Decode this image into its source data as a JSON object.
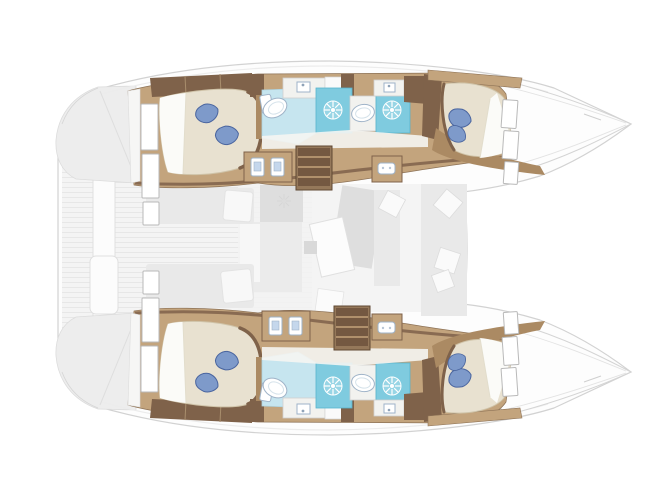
{
  "meta": {
    "name": "catamaran-yacht-floor-plan",
    "view": "top-down interior layout, bows to the right, no text labels in image"
  },
  "palette": {
    "hull-fill": "#fdfdfd",
    "hull-outline": "#d2d2d2",
    "deck-shade": "#ededed",
    "plank-base": "#f4f4f4",
    "plank-line": "#e6e6e6",
    "ghost": "#e9e9e9",
    "ghost-dark": "#dedede",
    "ghost-line": "#d8d8d8",
    "ghost-floor": "#f2f2f2",
    "wood": "#c3a47d",
    "wood-mid": "#ab8a63",
    "wood-dark": "#7f624a",
    "step-dark": "#745841",
    "step-light": "#caa87e",
    "mattress": "#e8e1d0",
    "mattress-edge": "#cfc3a8",
    "sheet": "#fbfbf8",
    "pillow": "#7e9aca",
    "pillow-dark": "#4a659f",
    "shower": "#7fcbdf",
    "shower-dark": "#58b4cd",
    "bath-floor": "#c6e5ef",
    "bath-edge": "#aed2de",
    "fix-stroke": "#9fb3c8",
    "fixture-blue": "#c5d7ec"
  },
  "layout": {
    "hulls": [
      {
        "id": "port-hull",
        "rooms": [
          {
            "name": "port-aft-cabin",
            "features": [
              "double-berth",
              "two-blue-pillows",
              "three-hull-windows",
              "wardrobe"
            ]
          },
          {
            "name": "port-aft-head",
            "features": [
              "wc",
              "sink-counter",
              "shower-with-star-drain",
              "blue-tile-floor"
            ]
          },
          {
            "name": "port-forward-head",
            "features": [
              "oval-sink",
              "shower-with-star-drain",
              "sink-counter"
            ]
          },
          {
            "name": "port-forward-cabin",
            "features": [
              "double-berth",
              "blue-pillow",
              "hull-windows"
            ]
          }
        ]
      },
      {
        "id": "starboard-hull",
        "rooms": [
          {
            "name": "starboard-aft-cabin",
            "features": [
              "double-berth",
              "two-blue-pillows",
              "three-hull-windows",
              "wardrobe"
            ]
          },
          {
            "name": "starboard-aft-head",
            "features": [
              "wc",
              "sink-counter",
              "shower-with-star-drain",
              "blue-tile-floor"
            ]
          },
          {
            "name": "starboard-forward-head",
            "features": [
              "oval-sink",
              "shower-with-star-drain",
              "sink-counter"
            ]
          },
          {
            "name": "starboard-forward-cabin",
            "features": [
              "double-berth",
              "blue-pillow",
              "hull-windows"
            ]
          }
        ]
      }
    ],
    "center": {
      "cockpit": [
        "teak-plank-deck",
        "cockpit-beam-with-fittings"
      ],
      "salon_ghost": [
        "sideboard",
        "sofa",
        "table",
        "chaise-lounge",
        "scatter-cushions",
        "berth-shadows",
        "ceiling-hatch-flakes"
      ],
      "companionways": [
        "port-stairs",
        "starboard-stairs",
        "port-cabinet-two-fixtures",
        "starboard-cabinet-two-fixtures",
        "utility-cabinet-port",
        "utility-cabinet-starboard"
      ]
    }
  }
}
